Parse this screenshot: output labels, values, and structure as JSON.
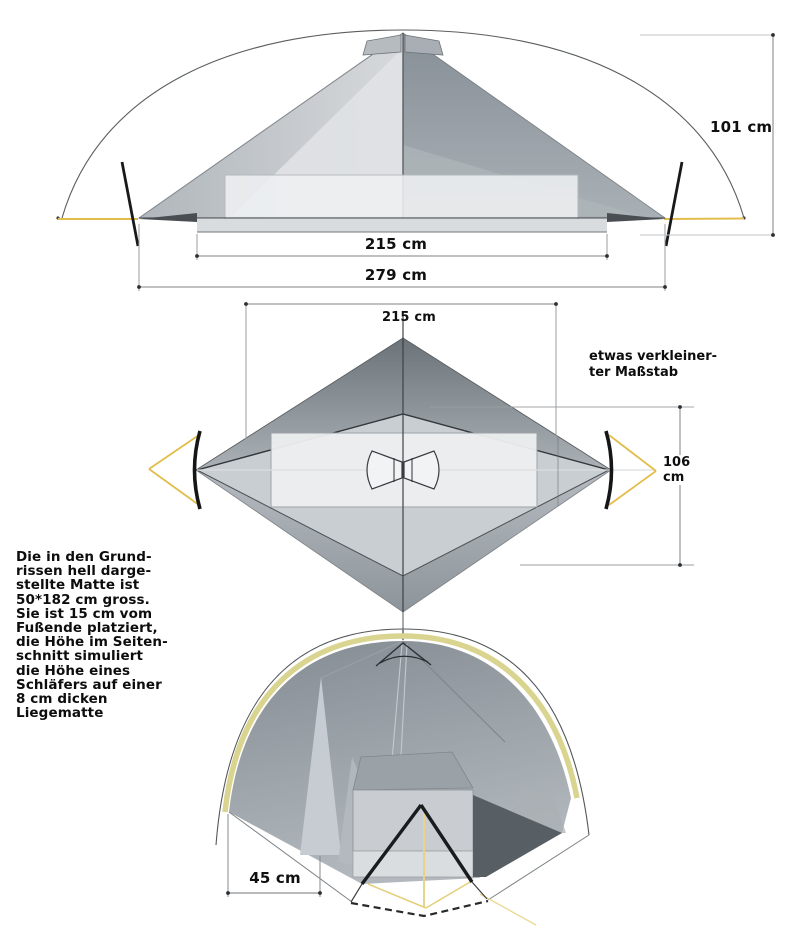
{
  "diagram": {
    "side_view": {
      "dim_inner_width": "215 cm",
      "dim_outer_width": "279 cm",
      "dim_height": "101 cm"
    },
    "plan_view": {
      "dim_length": "215 cm",
      "dim_width_value": "106",
      "dim_width_unit": "cm",
      "scale_note_line1": "etwas verkleiner-",
      "scale_note_line2": "ter Maßstab"
    },
    "front_view": {
      "dim_vestibule": "45 cm"
    },
    "mat_note_lines": [
      "Die in den Grund-",
      "rissen hell darge-",
      "stellte Matte ist",
      "50*182 cm gross.",
      "Sie ist 15 cm vom",
      "Fußende platziert,",
      "die Höhe im Seiten-",
      "schnitt simuliert",
      "die Höhe eines",
      "Schläfers auf einer",
      "8 cm dicken",
      "Liegematte"
    ],
    "colors": {
      "guyline_yellow": "#e2bd4c",
      "fly_trim_yellow": "#d9d48f",
      "fabric_dark": "#8b939a",
      "fabric_light": "#d7dadd",
      "mat_fill": "#eef0f2",
      "label_text": "#101010"
    }
  }
}
